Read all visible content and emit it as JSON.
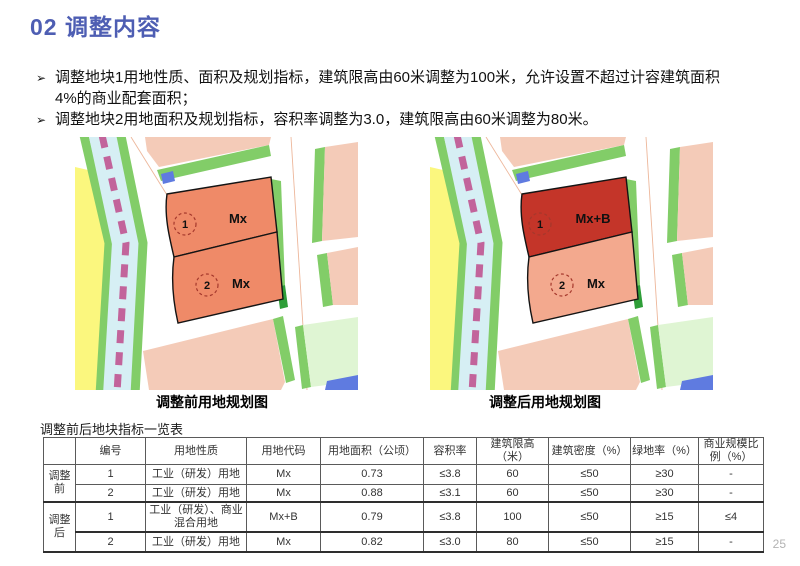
{
  "slide": {
    "title": "02 调整内容",
    "page_number": "25"
  },
  "content": {
    "bullets": [
      {
        "marker": "➢",
        "lines": [
          "调整地块1用地性质、面积及规划指标，建筑限高由60米调整为100米，允许设置不超过计容建筑面积",
          "4%的商业配套面积；"
        ]
      },
      {
        "marker": "➢",
        "lines": [
          "调整地块2用地面积及规划指标，容积率调整为3.0，建筑限高由60米调整为80米。"
        ]
      }
    ]
  },
  "figures": {
    "before": {
      "caption": "调整前用地规划图",
      "parcels": [
        {
          "num": "1",
          "label": "Mx",
          "color": "#ef8a68"
        },
        {
          "num": "2",
          "label": "Mx",
          "color": "#ef8a68"
        }
      ]
    },
    "after": {
      "caption": "调整后用地规划图",
      "parcels": [
        {
          "num": "1",
          "label": "Mx+B",
          "color": "#c43529"
        },
        {
          "num": "2",
          "label": "Mx",
          "color": "#f3a98e"
        }
      ]
    }
  },
  "table": {
    "title": "调整前后地块指标一览表",
    "headers": [
      "",
      "编号",
      "用地性质",
      "用地代码",
      "用地面积（公顷）",
      "容积率",
      "建筑限高（米）",
      "建筑密度（%）",
      "绿地率（%）",
      "商业规模比例（%）"
    ],
    "groups": [
      {
        "label": "调整前",
        "rows": [
          [
            "1",
            "工业（研发）用地",
            "Mx",
            "0.73",
            "≤3.8",
            "60",
            "≤50",
            "≥30",
            "-"
          ],
          [
            "2",
            "工业（研发）用地",
            "Mx",
            "0.88",
            "≤3.1",
            "60",
            "≤50",
            "≥30",
            "-"
          ]
        ]
      },
      {
        "label": "调整后",
        "rows": [
          [
            "1",
            "工业（研发）、商业混合用地",
            "Mx+B",
            "0.79",
            "≤3.8",
            "100",
            "≤50",
            "≥15",
            "≤4"
          ],
          [
            "2",
            "工业（研发）用地",
            "Mx",
            "0.82",
            "≤3.0",
            "80",
            "≤50",
            "≥15",
            "-"
          ]
        ]
      }
    ]
  },
  "colors": {
    "title_blue": "#4e5eb3",
    "map_yellow": "#fbf77e",
    "map_canal_cyan": "#d6eff4",
    "map_green": "#82cd68",
    "map_green_dark": "#2e9e38",
    "map_magenta_dash": "#c2649b",
    "map_pink": "#f4cbb8",
    "map_lightgreen_parcel": "#dff5d3",
    "map_blue": "#5f7be0",
    "map_road_centerline": "#edb79b",
    "parcel_outline": "#141414",
    "number_circle_red": "#a5382c"
  }
}
